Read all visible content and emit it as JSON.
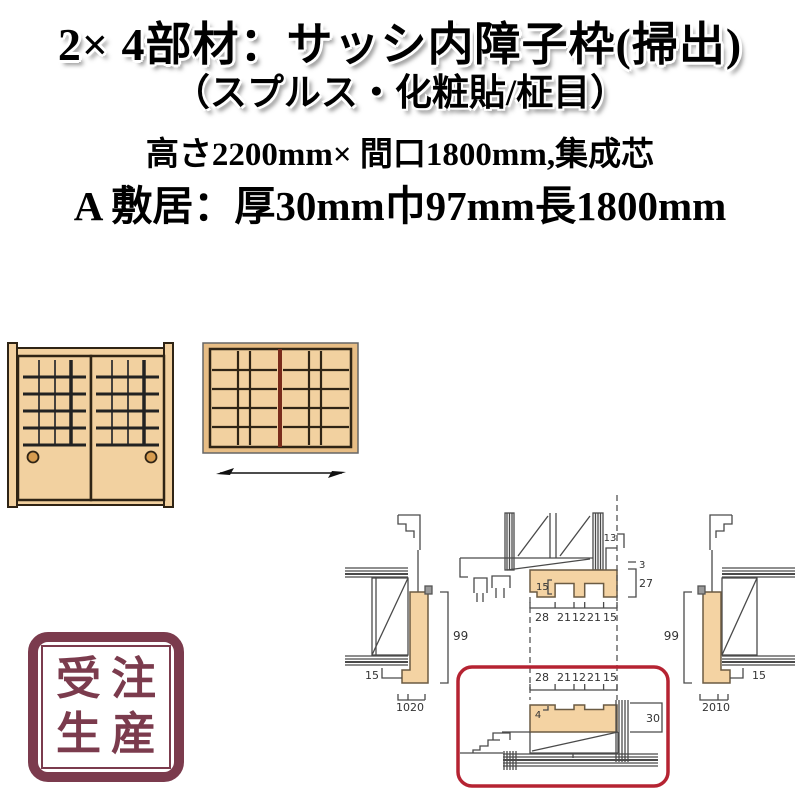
{
  "header": {
    "title_line1": "2× 4部材：サッシ内障子枠(掃出)",
    "title_line2": "（スプルス・化粧貼/柾目）",
    "spec_line1": "高さ2200mm× 間口1800mm,集成芯",
    "spec_line2": "A 敷居：厚30mm巾97mm長1800mm"
  },
  "drawing": {
    "head": {
      "side": "13",
      "groove": "15",
      "gap": "3",
      "depth": "27",
      "widths": [
        "28",
        "21",
        "12",
        "21",
        "15"
      ]
    },
    "sill": {
      "widths": [
        "28",
        "21",
        "12",
        "21",
        "15"
      ],
      "groove_depth": "4",
      "thickness": "30"
    },
    "left_jamb": {
      "height": "99",
      "foot": "15",
      "dims": [
        "10",
        "20"
      ]
    },
    "right_jamb": {
      "height": "99",
      "foot": "15",
      "dims": [
        "20",
        "10"
      ]
    }
  },
  "stamp": {
    "line1": "受注",
    "line2": "生産"
  },
  "colors": {
    "wood_fill": "#f2d1a0",
    "wood_outline": "#2f2415",
    "handle": "#d79c4f",
    "frame_divider": "#7a2c1c",
    "drawing_wood": "#f4d3a3",
    "drawing_line": "#4a4a4a",
    "highlight_box": "#b52332",
    "stamp": "#7b3b4d"
  }
}
